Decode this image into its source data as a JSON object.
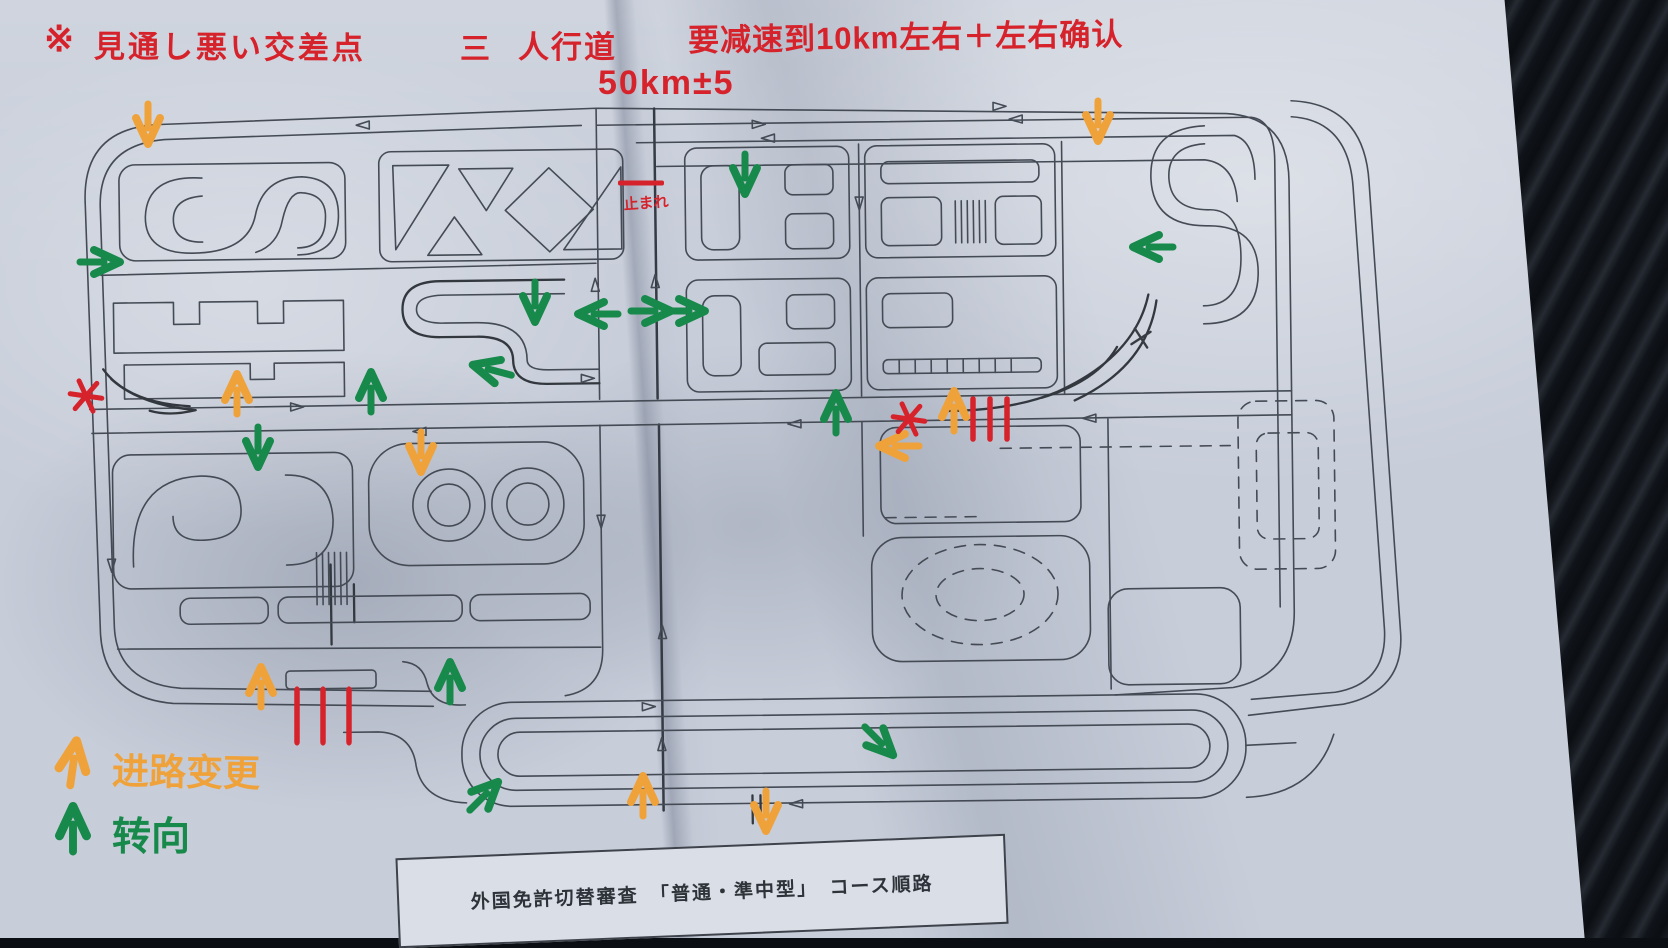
{
  "notes": {
    "blind_symbol": "※",
    "blind": "見通し悪い交差点",
    "crosswalk_symbol": "三",
    "crosswalk": "人行道",
    "speed_rule": "要减速到10km左右＋左右确认",
    "speed_limit": "50km±5",
    "stop": "止まれ"
  },
  "legend": {
    "lane_change": {
      "symbol": "↑",
      "label": "进路变更",
      "color": "#f0a23a"
    },
    "turn": {
      "symbol": "↑",
      "label": "转向",
      "color": "#17894a"
    }
  },
  "footer": {
    "title": "外国免許切替審査　「普通・準中型」　コース順路"
  },
  "colors": {
    "red": "#d6232b",
    "orange": "#f0a23a",
    "green": "#17894a",
    "ink": "#454b55",
    "paper": "#c7cdd9",
    "background": "#0b0e12"
  },
  "markers": {
    "turn_arrows": [
      [
        100,
        262,
        90
      ],
      [
        745,
        174,
        180
      ],
      [
        535,
        302,
        180
      ],
      [
        598,
        314,
        270
      ],
      [
        651,
        311,
        90
      ],
      [
        685,
        311,
        90
      ],
      [
        1153,
        247,
        270
      ],
      [
        836,
        413,
        0
      ],
      [
        450,
        682,
        0
      ],
      [
        484,
        796,
        45
      ],
      [
        879,
        741,
        135
      ],
      [
        258,
        447,
        180
      ],
      [
        371,
        392,
        0
      ],
      [
        492,
        370,
        285
      ]
    ],
    "lane_change_arrows": [
      [
        148,
        124,
        180
      ],
      [
        1098,
        121,
        180
      ],
      [
        237,
        394,
        0
      ],
      [
        421,
        452,
        180
      ],
      [
        899,
        446,
        270
      ],
      [
        954,
        411,
        0
      ],
      [
        261,
        687,
        0
      ],
      [
        643,
        796,
        0
      ],
      [
        766,
        811,
        180
      ]
    ],
    "blind_spots": [
      [
        86,
        396
      ],
      [
        909,
        419
      ]
    ],
    "pen_cross": [
      [
        1141,
        338
      ]
    ],
    "crosswalk_ticks": [
      {
        "x": 973,
        "y": 419,
        "count": 3,
        "gap": 17,
        "len": 40
      },
      {
        "x": 297,
        "y": 716,
        "count": 3,
        "gap": 26,
        "len": 52
      }
    ],
    "stop_line": {
      "x": 641,
      "y": 183,
      "width": 46
    }
  }
}
